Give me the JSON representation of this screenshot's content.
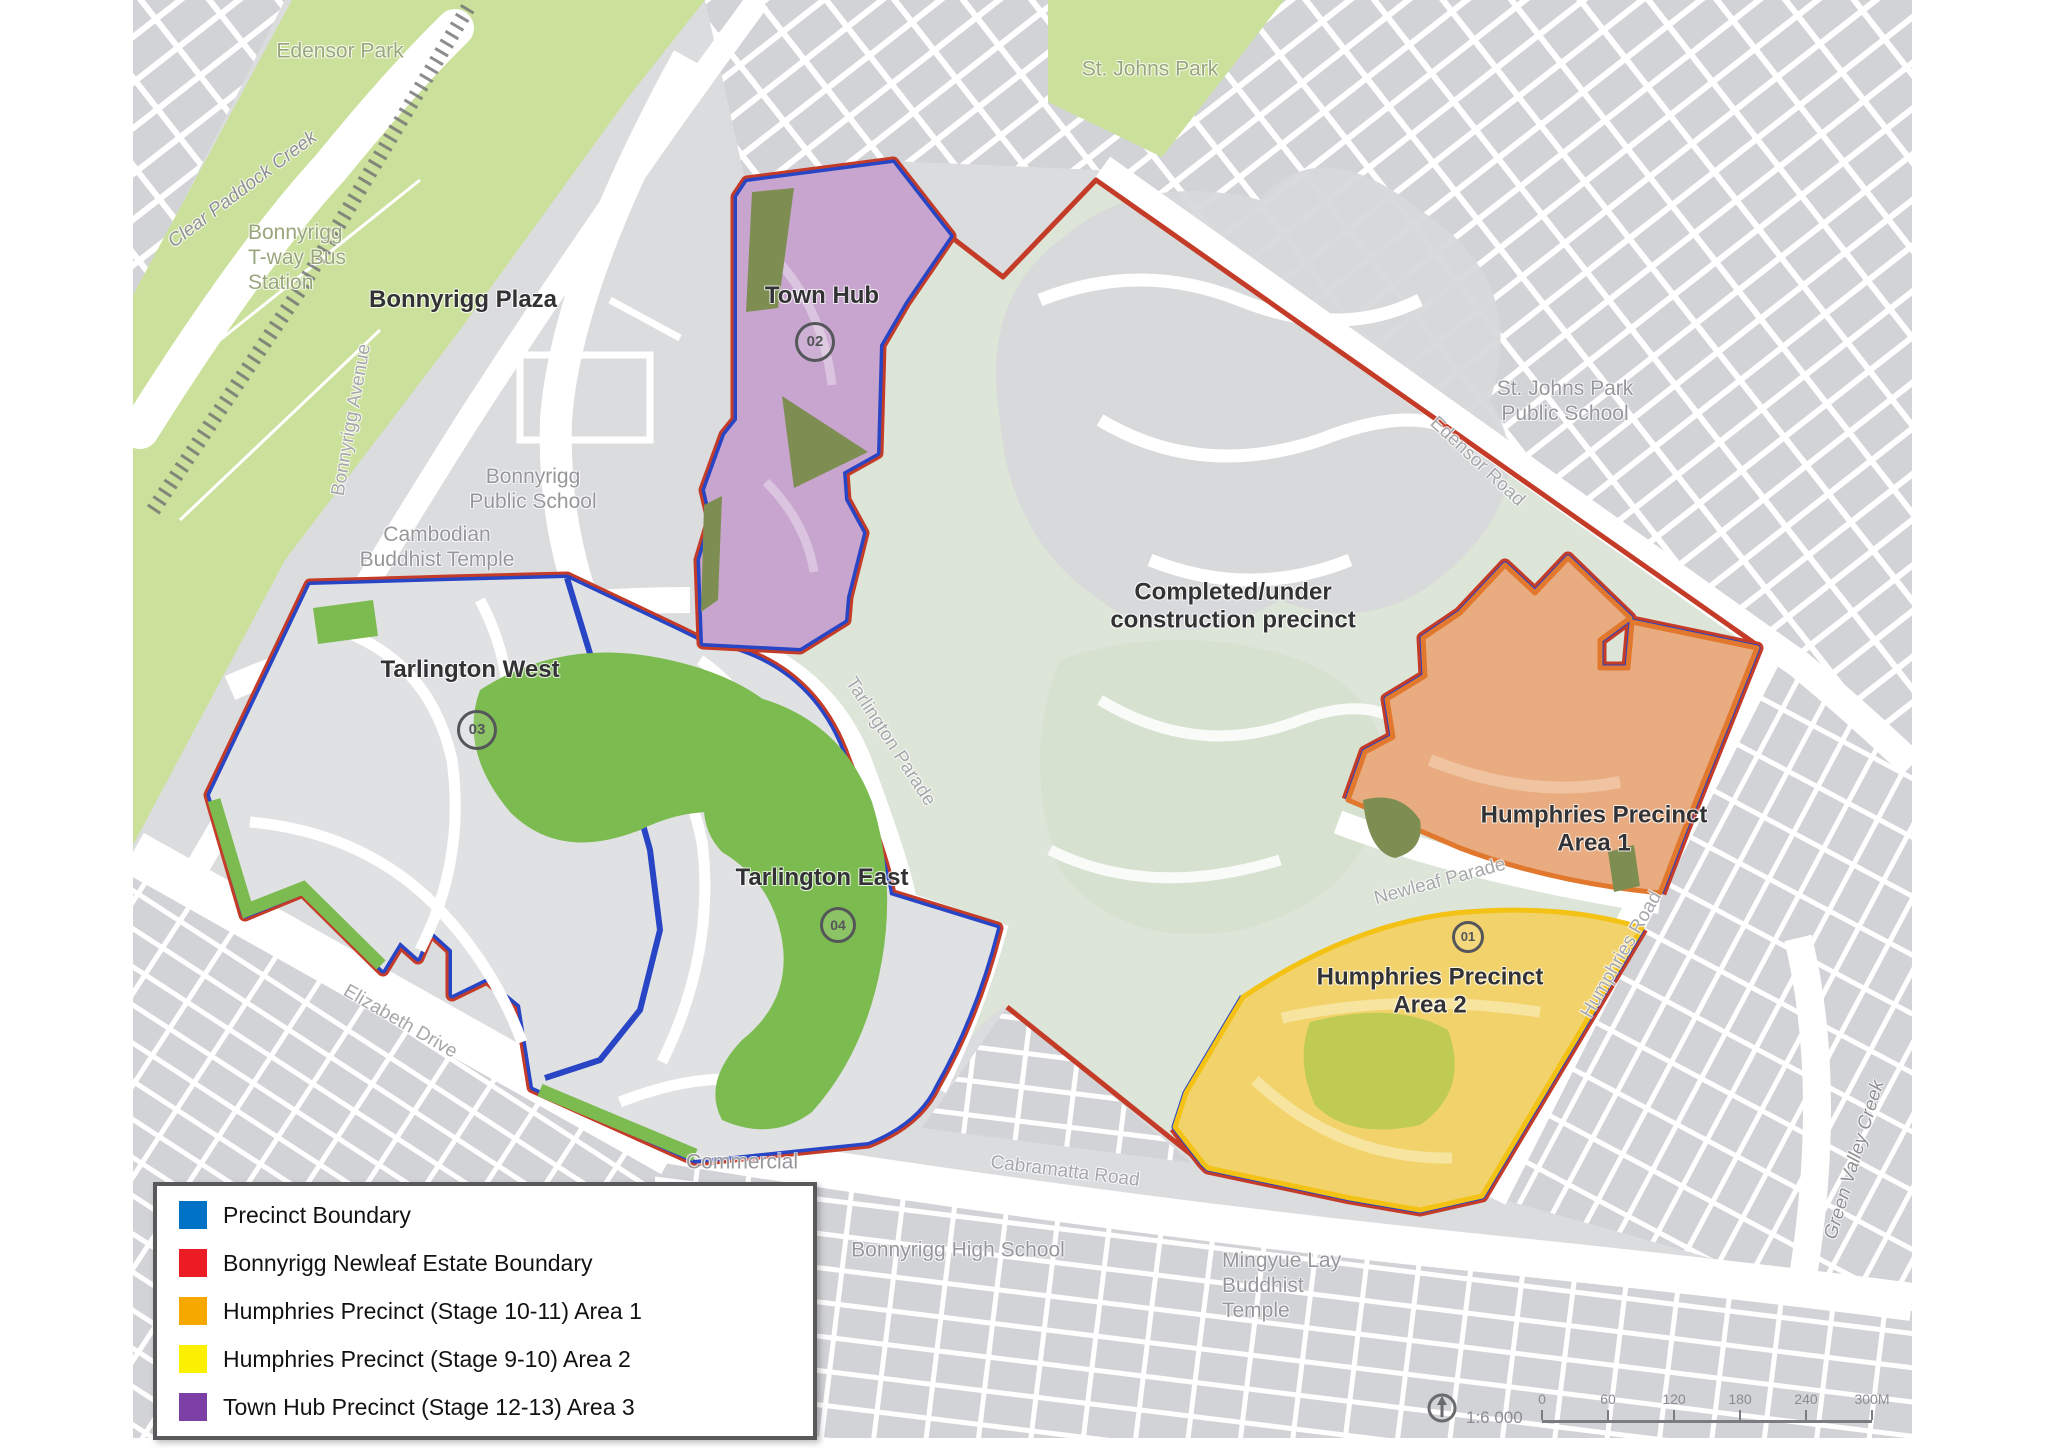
{
  "colors": {
    "map_gray": "#DBDCDE",
    "block_gray": "#D2D3D6",
    "park_green": "#CBE19B",
    "estate_green": "#7CBB50",
    "olive_green": "#7E8E52",
    "olive_yellow": "#BFCB52",
    "sage": "#DCE5D8",
    "town_hub_fill": "#C7A5CE",
    "town_hub_street": "#DAC4DF",
    "area1_fill": "#E8AC80",
    "area1_stroke": "#E2782E",
    "area2_fill": "#F2D36B",
    "area2_stroke": "#F3C214",
    "precinct_boundary_blue": "#2745C5",
    "estate_boundary_red": "#C43B28",
    "legend_blue": "#0072C6",
    "legend_red": "#EC1C24",
    "legend_orange": "#F6A800",
    "legend_yellow": "#FBF000",
    "legend_purple": "#7B3FA5"
  },
  "map": {
    "labels": [
      {
        "id": "edensor-park-label",
        "text": "Edensor Park",
        "x": 340,
        "y": 52,
        "rot": 0,
        "cls": "park"
      },
      {
        "id": "st-johns-park-label",
        "text": "St. Johns Park",
        "x": 1150,
        "y": 70,
        "rot": 0,
        "cls": "park"
      },
      {
        "id": "clear-paddock-creek-label",
        "text": "Clear Paddock Creek",
        "x": 243,
        "y": 190,
        "rot": -37,
        "cls": "water"
      },
      {
        "id": "bonnyrigg-tway-station-label",
        "text": "Bonnyrigg\nT-way Bus\nStation",
        "x": 248,
        "y": 258,
        "rot": 0,
        "cls": "park",
        "align": "left"
      },
      {
        "id": "bonnyrigg-avenue-label",
        "text": "Bonnyrigg Avenue",
        "x": 352,
        "y": 420,
        "rot": -80,
        "cls": "road"
      },
      {
        "id": "bonnyrigg-plaza-label",
        "text": "Bonnyrigg Plaza",
        "x": 463,
        "y": 300,
        "rot": 0,
        "cls": "bold"
      },
      {
        "id": "bonnyrigg-public-school-label",
        "text": "Bonnyrigg\nPublic School",
        "x": 533,
        "y": 490,
        "rot": 0,
        "cls": "gray"
      },
      {
        "id": "cambodian-buddhist-temple-label",
        "text": "Cambodian\nBuddhist Temple",
        "x": 437,
        "y": 548,
        "rot": 0,
        "cls": "gray"
      },
      {
        "id": "town-hub-label",
        "text": "Town Hub",
        "x": 822,
        "y": 296,
        "rot": 0,
        "cls": "bold"
      },
      {
        "id": "tarlington-west-label",
        "text": "Tarlington West",
        "x": 470,
        "y": 670,
        "rot": 0,
        "cls": "bold"
      },
      {
        "id": "tarlington-east-label",
        "text": "Tarlington East",
        "x": 822,
        "y": 878,
        "rot": 0,
        "cls": "bold"
      },
      {
        "id": "completed-precinct-label",
        "text": "Completed/under\nconstruction precinct",
        "x": 1233,
        "y": 607,
        "rot": 0,
        "cls": "bold"
      },
      {
        "id": "edensor-road-label",
        "text": "Edensor Road",
        "x": 1477,
        "y": 462,
        "rot": 43,
        "cls": "road"
      },
      {
        "id": "st-johns-park-public-school-label",
        "text": "St. Johns Park\nPublic School",
        "x": 1565,
        "y": 402,
        "rot": 0,
        "cls": "gray"
      },
      {
        "id": "humphries-precinct-area1-label",
        "text": "Humphries Precinct\nArea 1",
        "x": 1594,
        "y": 830,
        "rot": 0,
        "cls": "bold"
      },
      {
        "id": "newleaf-parade-label",
        "text": "Newleaf Parade",
        "x": 1440,
        "y": 882,
        "rot": -15,
        "cls": "road"
      },
      {
        "id": "humphries-precinct-area2-label",
        "text": "Humphries Precinct\nArea 2",
        "x": 1430,
        "y": 992,
        "rot": 0,
        "cls": "bold"
      },
      {
        "id": "humphries-road-label",
        "text": "Humphries Road",
        "x": 1622,
        "y": 955,
        "rot": -60,
        "cls": "road"
      },
      {
        "id": "tarlington-parade-label",
        "text": "Tarlington Parade",
        "x": 890,
        "y": 742,
        "rot": 57,
        "cls": "road"
      },
      {
        "id": "elizabeth-drive-label",
        "text": "Elizabeth Drive",
        "x": 400,
        "y": 1022,
        "rot": 30,
        "cls": "road"
      },
      {
        "id": "commercial-label",
        "text": "Commercial",
        "x": 742,
        "y": 1163,
        "rot": 0,
        "cls": "gray"
      },
      {
        "id": "cabramatta-road-label",
        "text": "Cabramatta Road",
        "x": 1065,
        "y": 1172,
        "rot": 7,
        "cls": "road"
      },
      {
        "id": "bonnyrigg-high-school-label",
        "text": "Bonnyrigg High School",
        "x": 958,
        "y": 1251,
        "rot": 0,
        "cls": "gray"
      },
      {
        "id": "mingyue-lay-buddhist-temple-label",
        "text": "Mingyue Lay\nBuddhist\nTemple",
        "x": 1222,
        "y": 1286,
        "rot": 0,
        "cls": "gray",
        "align": "left"
      },
      {
        "id": "green-valley-creek-label",
        "text": "Green Valley Creek",
        "x": 1855,
        "y": 1160,
        "rot": -73,
        "cls": "water"
      },
      {
        "id": "badge-town-hub",
        "text": "02",
        "x": 815,
        "y": 342,
        "rot": 0,
        "cls": "badge",
        "d": 34,
        "fs": 15
      },
      {
        "id": "badge-tarlington-west",
        "text": "03",
        "x": 477,
        "y": 730,
        "rot": 0,
        "cls": "badge",
        "d": 34,
        "fs": 15
      },
      {
        "id": "badge-tarlington-east",
        "text": "04",
        "x": 838,
        "y": 925,
        "rot": 0,
        "cls": "badge",
        "d": 30,
        "fs": 14
      },
      {
        "id": "badge-humphries",
        "text": "01",
        "x": 1468,
        "y": 937,
        "rot": 0,
        "cls": "badge",
        "d": 26,
        "fs": 13
      }
    ]
  },
  "legend": {
    "items": [
      {
        "label": "Precinct Boundary",
        "color": "#0072C6"
      },
      {
        "label": "Bonnyrigg Newleaf Estate Boundary",
        "color": "#EC1C24"
      },
      {
        "label": "Humphries Precinct (Stage 10-11) Area 1",
        "color": "#F6A800"
      },
      {
        "label": "Humphries Precinct (Stage 9-10) Area 2",
        "color": "#FBF000"
      },
      {
        "label": "Town Hub Precinct (Stage 12-13) Area 3",
        "color": "#7B3FA5"
      }
    ]
  },
  "scalebar": {
    "ratio_label": "1:6 000",
    "ticks": [
      "0",
      "60",
      "120",
      "180",
      "240",
      "300M"
    ]
  }
}
